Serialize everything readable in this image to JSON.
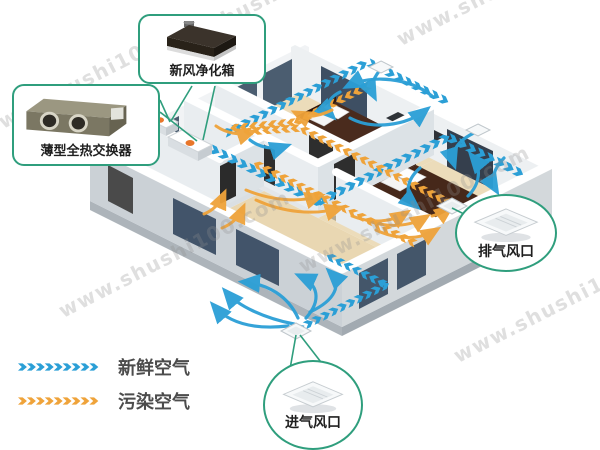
{
  "callouts": {
    "purifier": {
      "label": "新风净化箱"
    },
    "heat_exchanger": {
      "label": "薄型全热交换器"
    },
    "exhaust_vent": {
      "label": "排气风口"
    },
    "intake_vent": {
      "label": "进气风口"
    }
  },
  "legend": {
    "fresh_air": {
      "label": "新鲜空气",
      "color": "#2b9fd6"
    },
    "polluted_air": {
      "label": "污染空气",
      "color": "#efa33a"
    }
  },
  "watermark": {
    "text": "www.shushi100.com"
  },
  "colors": {
    "callout_border": "#2f9e7d"
  }
}
